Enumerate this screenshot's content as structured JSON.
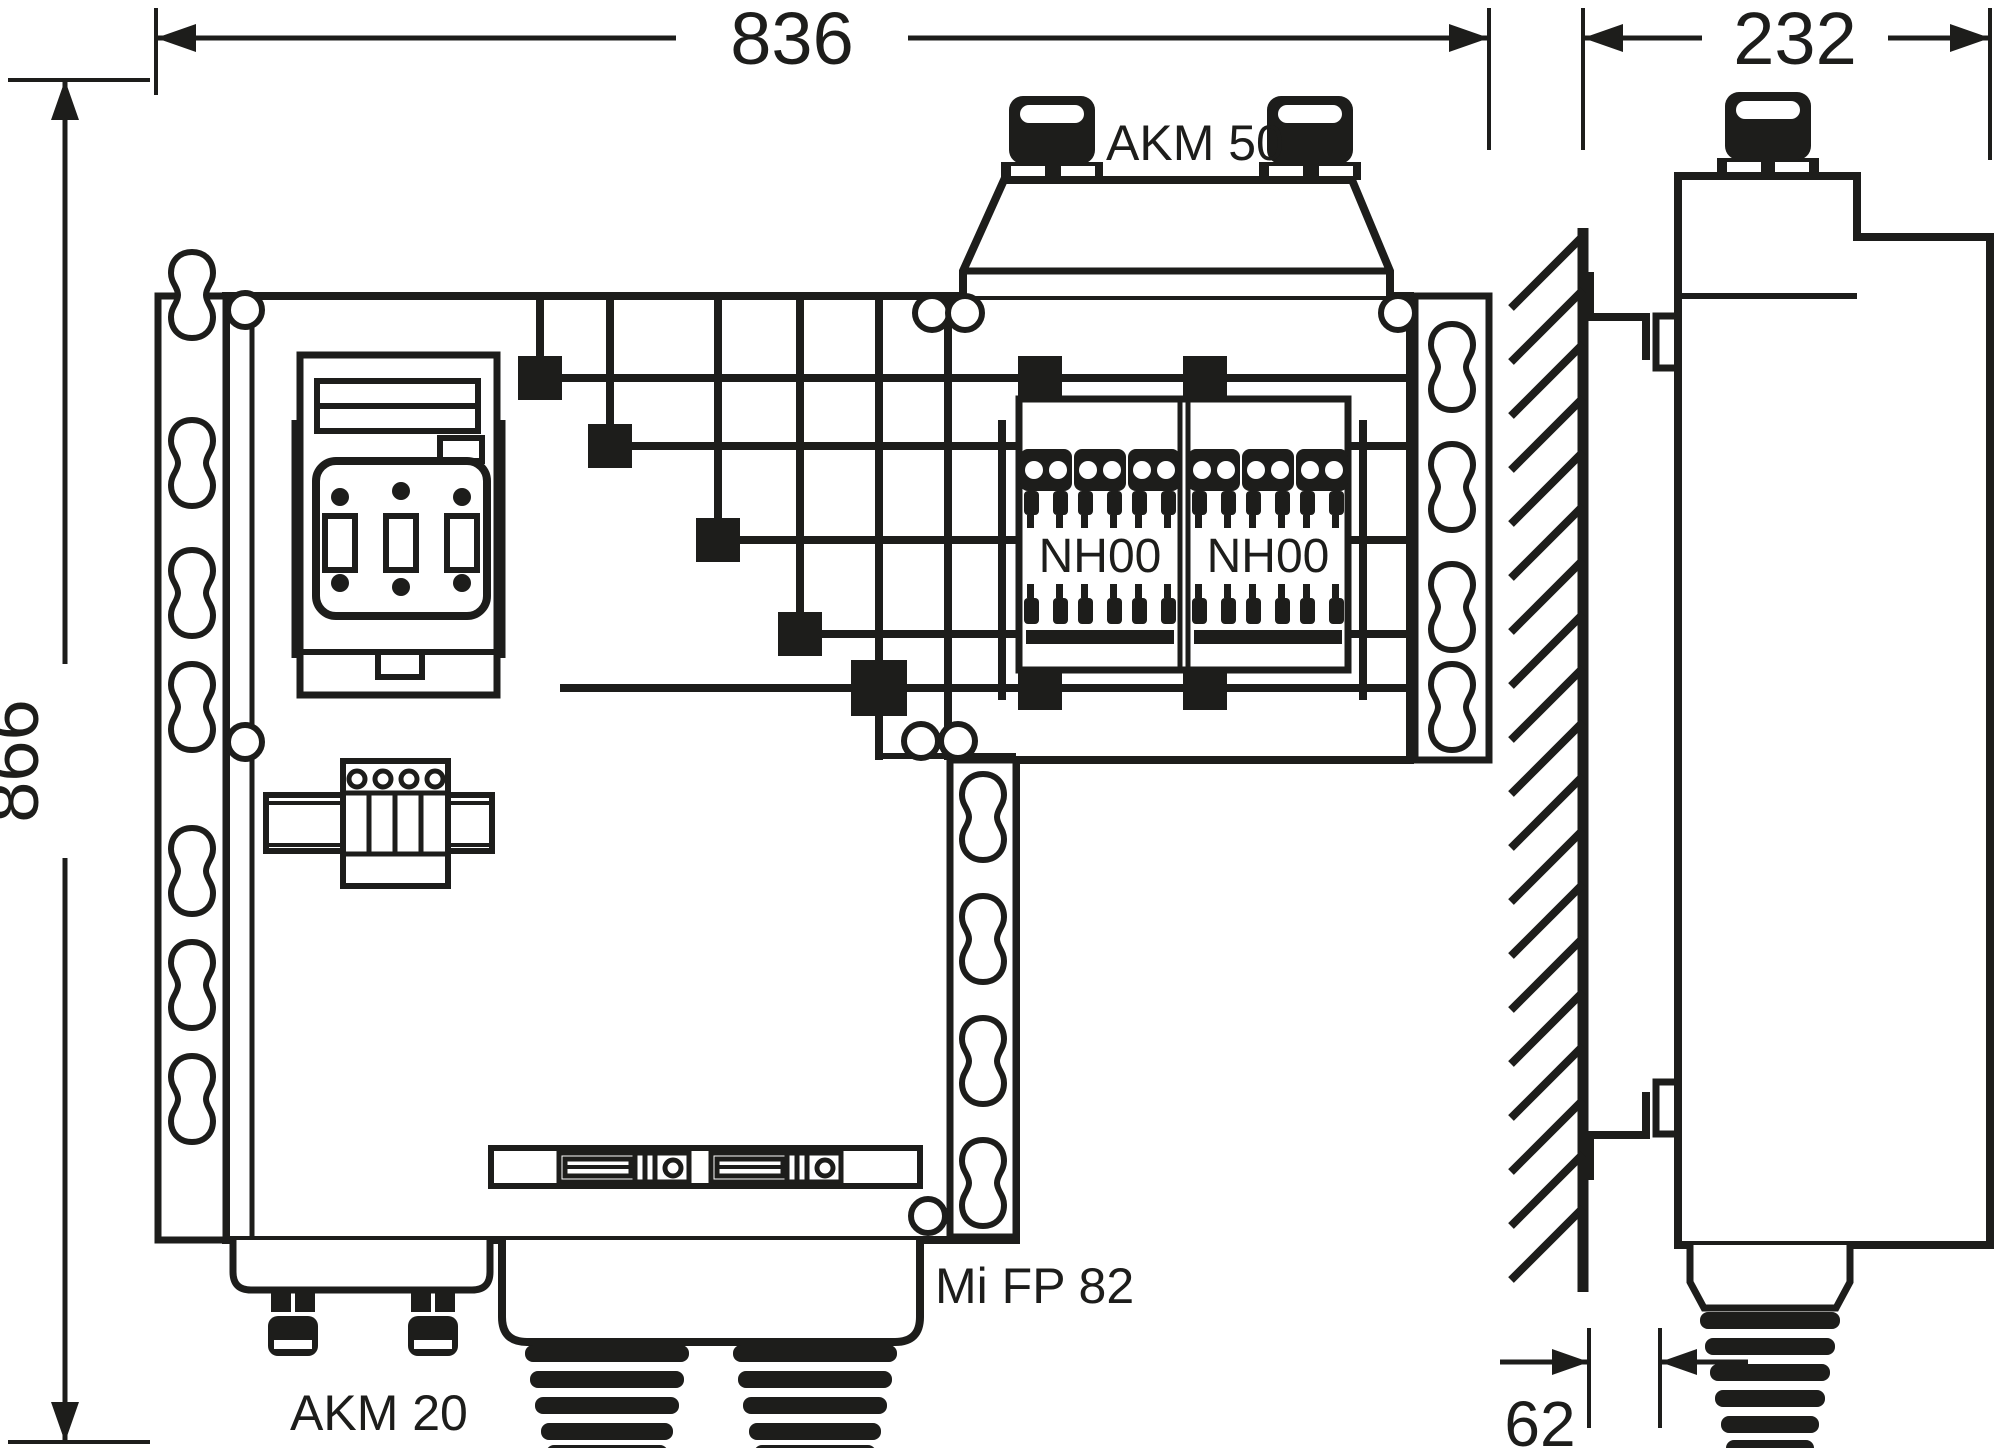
{
  "dimensions": {
    "front_width": "836",
    "front_height": "866",
    "side_depth": "232",
    "wall_offset": "62"
  },
  "labels": {
    "top_glands": "AKM 50",
    "bottom_glands": "AKM 20",
    "fuse_strip_left": "NH00",
    "fuse_strip_right": "NH00",
    "enclosure_model": "Mi FP 82"
  },
  "colors": {
    "line": "#1d1d1b",
    "background": "#ffffff"
  }
}
